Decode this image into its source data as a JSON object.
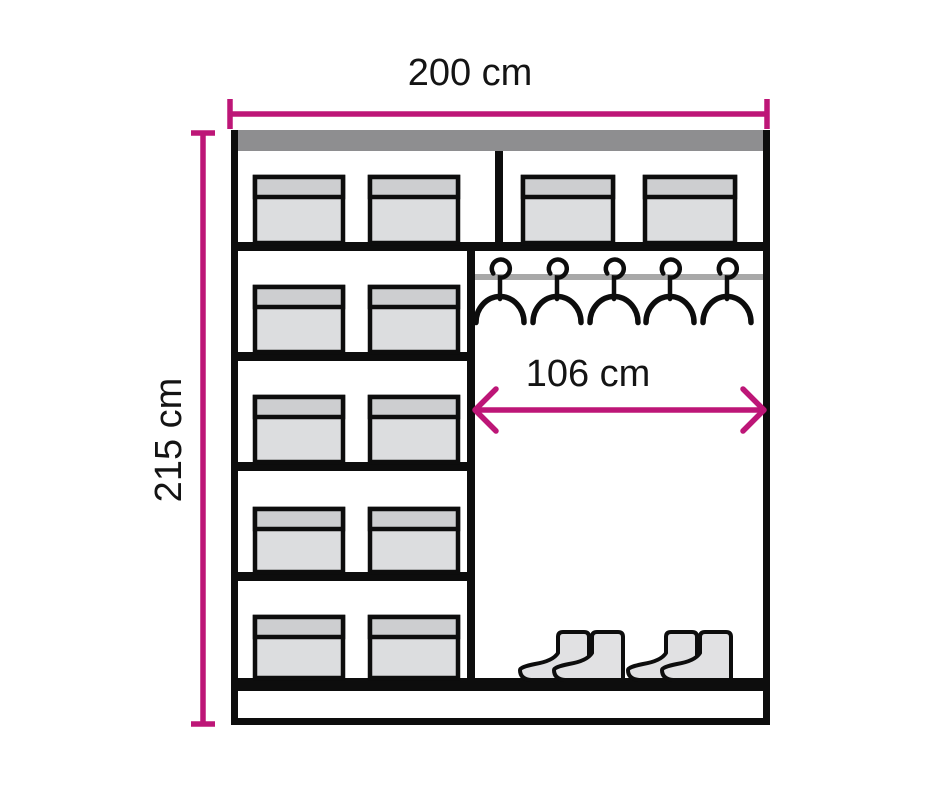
{
  "dimensions": {
    "width": {
      "label": "200 cm"
    },
    "height": {
      "label": "215 cm"
    },
    "inner_width": {
      "label": "106 cm"
    }
  },
  "wardrobe": {
    "left_column": {
      "rows": 5,
      "boxes_per_row": 2
    },
    "top_shelf_right": {
      "boxes": 2
    },
    "right_section": {
      "hangers": 5,
      "boot_pairs": 2
    }
  },
  "colors": {
    "dimension_accent": "#bd1677",
    "outline": "#0d0d0d",
    "top_panel_gray": "#8e8e90",
    "rail_gray": "#a8a8a8",
    "box_lid_gray": "#cdced0",
    "box_body_gray": "#dcdddf",
    "boot_gray": "#e1e1e3",
    "text_color": "#141414",
    "background": "#ffffff"
  }
}
